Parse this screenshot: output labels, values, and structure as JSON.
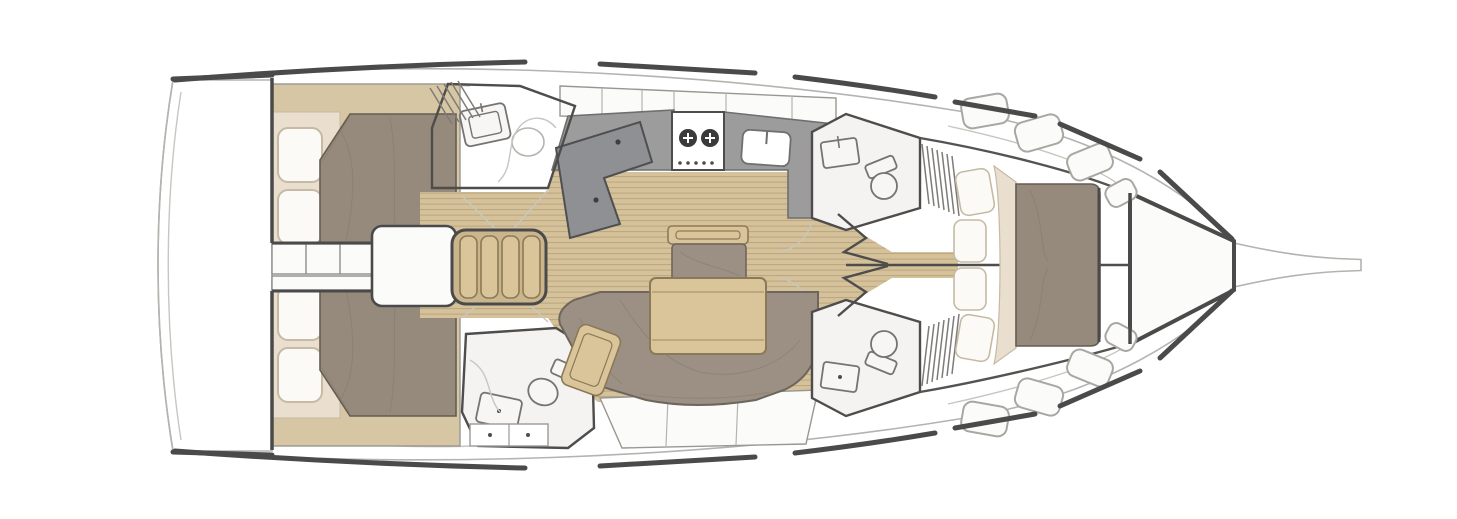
{
  "diagram": {
    "type": "sailboat-interior-floor-plan",
    "view": "top-down",
    "orientation": "bow-right",
    "areas": [
      "swim-platform-transom",
      "aft-cabin-port",
      "aft-cabin-starboard",
      "companionway-steps",
      "engine-box",
      "galley",
      "nav-station",
      "head-aft-port",
      "head-aft-starboard",
      "saloon-settee",
      "saloon-table",
      "saloon-bench",
      "head-forward-port",
      "head-forward-starboard",
      "forward-cabin-island-bed",
      "anchor-locker",
      "bowsprit"
    ],
    "galley": {
      "burner_count": 2,
      "sink_count": 1
    }
  },
  "colors": {
    "background": "#ffffff",
    "deck": "#edecea",
    "room": "#f5f3f1",
    "white_panel": "#fbfbfa",
    "fixture": "#f7f6f4",
    "hull_dark": "#4a4a4a",
    "hull_light": "#b5b3ae",
    "wall": "#4e4d4b",
    "floor_wood": "#d5c29b",
    "floor_line": "#b9a67e",
    "wood": "#dac59a",
    "wood_dark": "#8b7a57",
    "trim_tan": "#d7c6a4",
    "counter": "#9c9c9c",
    "nav": "#8e9093",
    "upholstery": "#9b9083",
    "upholstery_dark": "#6e665c",
    "duvet": "#968a7d",
    "duvet_dark": "#655d52",
    "mattress": "#eadfce",
    "pillow": "#fbfaf7",
    "pillow_edge": "#c6baa4",
    "burner": "#3a3a3a"
  }
}
